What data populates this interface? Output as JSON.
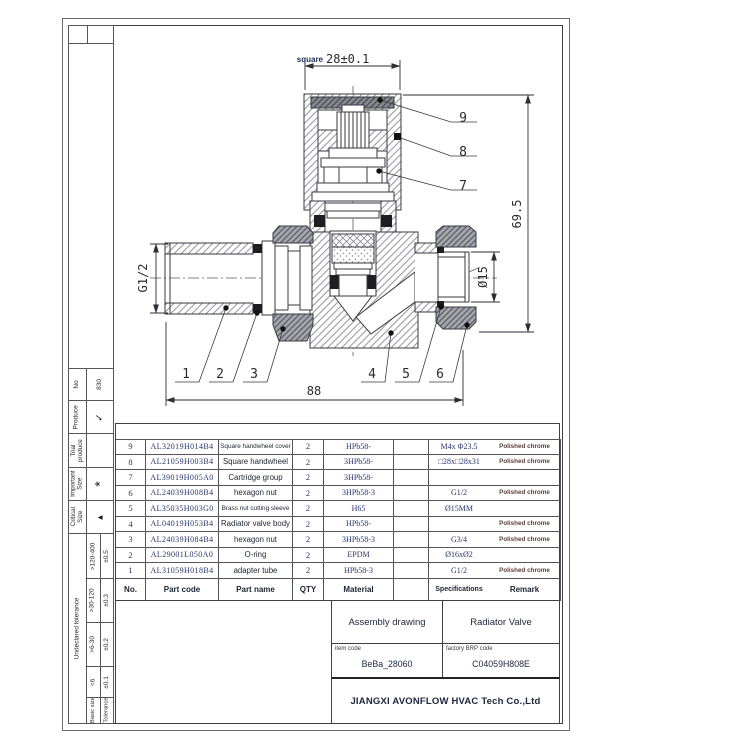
{
  "sheet": {
    "no_label": "No",
    "no_value": "830",
    "produce_label": "Produce",
    "produce_value": "✓",
    "trial_label": "Trial produce",
    "trial_value": "",
    "important_label": "Important Size",
    "important_value": "*",
    "critical_label": "Critical Size",
    "critical_value": "▲",
    "undeclared_tolerance_label": "Undeclared tolerance",
    "tolerance_rows": [
      {
        "basic": ">120-400",
        "tol": "±0.5"
      },
      {
        "basic": ">30-120",
        "tol": "±0.3"
      },
      {
        "basic": ">6-30",
        "tol": "±0.2"
      },
      {
        "basic": "<6",
        "tol": "±0.1"
      }
    ],
    "basic_size_label": "Basic size",
    "tolerance_label": "Tolerance"
  },
  "drawing": {
    "dims": {
      "square_label": "square",
      "square_value": "28±0.1",
      "height": "69.5",
      "diameter": "Ø15",
      "thread_left": "G1/2",
      "length": "88"
    },
    "callouts": [
      "1",
      "2",
      "3",
      "4",
      "5",
      "6",
      "7",
      "8",
      "9"
    ]
  },
  "table": {
    "headers": {
      "no": "No.",
      "part_code": "Part code",
      "part_name": "Part name",
      "qty": "QTY",
      "material": "Material",
      "spec": "Specifications",
      "remark": "Remark"
    },
    "rows": [
      {
        "no": "9",
        "code": "AL32019H014B4",
        "name": "Square handwheel cover",
        "qty": "2",
        "material": "HPb58-",
        "spec": "M4x Φ23.5",
        "remark": "Polished chrome"
      },
      {
        "no": "8",
        "code": "AL21059H003B4",
        "name": "Square handwheel",
        "qty": "2",
        "material": "3HPb58-",
        "spec": "□28x□28x31",
        "remark": "Polished chrome"
      },
      {
        "no": "7",
        "code": "AL39019H005A0",
        "name": "Cartridge group",
        "qty": "2",
        "material": "3HPb58-",
        "spec": "",
        "remark": ""
      },
      {
        "no": "6",
        "code": "AL24039H008B4",
        "name": "hexagon nut",
        "qty": "2",
        "material": "3HPb58-3",
        "spec": "G1/2",
        "remark": "Polished chrome"
      },
      {
        "no": "5",
        "code": "AL35035H003G0",
        "name": "Brass nut cutting sleeve",
        "qty": "2",
        "material": "H65",
        "spec": "Ø15MM",
        "remark": ""
      },
      {
        "no": "4",
        "code": "AL04019H053B4",
        "name": "Radiator valve body",
        "qty": "2",
        "material": "HPb58-",
        "spec": "",
        "remark": "Polished chrome"
      },
      {
        "no": "3",
        "code": "AL24039H084B4",
        "name": "hexagon nut",
        "qty": "2",
        "material": "3HPb58-3",
        "spec": "G3/4",
        "remark": "Polished chrome"
      },
      {
        "no": "2",
        "code": "AL29001L050A0",
        "name": "O-ring",
        "qty": "2",
        "material": "EPDM",
        "spec": "Ø16xØ2",
        "remark": ""
      },
      {
        "no": "1",
        "code": "AL31059H018B4",
        "name": "adapter tube",
        "qty": "2",
        "material": "HPb58-3",
        "spec": "G1/2",
        "remark": "Polished chrome"
      }
    ]
  },
  "title_block": {
    "drawing_type": "Assembly drawing",
    "product_name": "Radiator Valve",
    "item_code_label": "item code",
    "item_code": "BeBa_28060",
    "erp_label": "factory BRP code",
    "erp_code": "C04059H808E",
    "company": "JIANGXI AVONFLOW HVAC Tech Co.,Ltd"
  }
}
